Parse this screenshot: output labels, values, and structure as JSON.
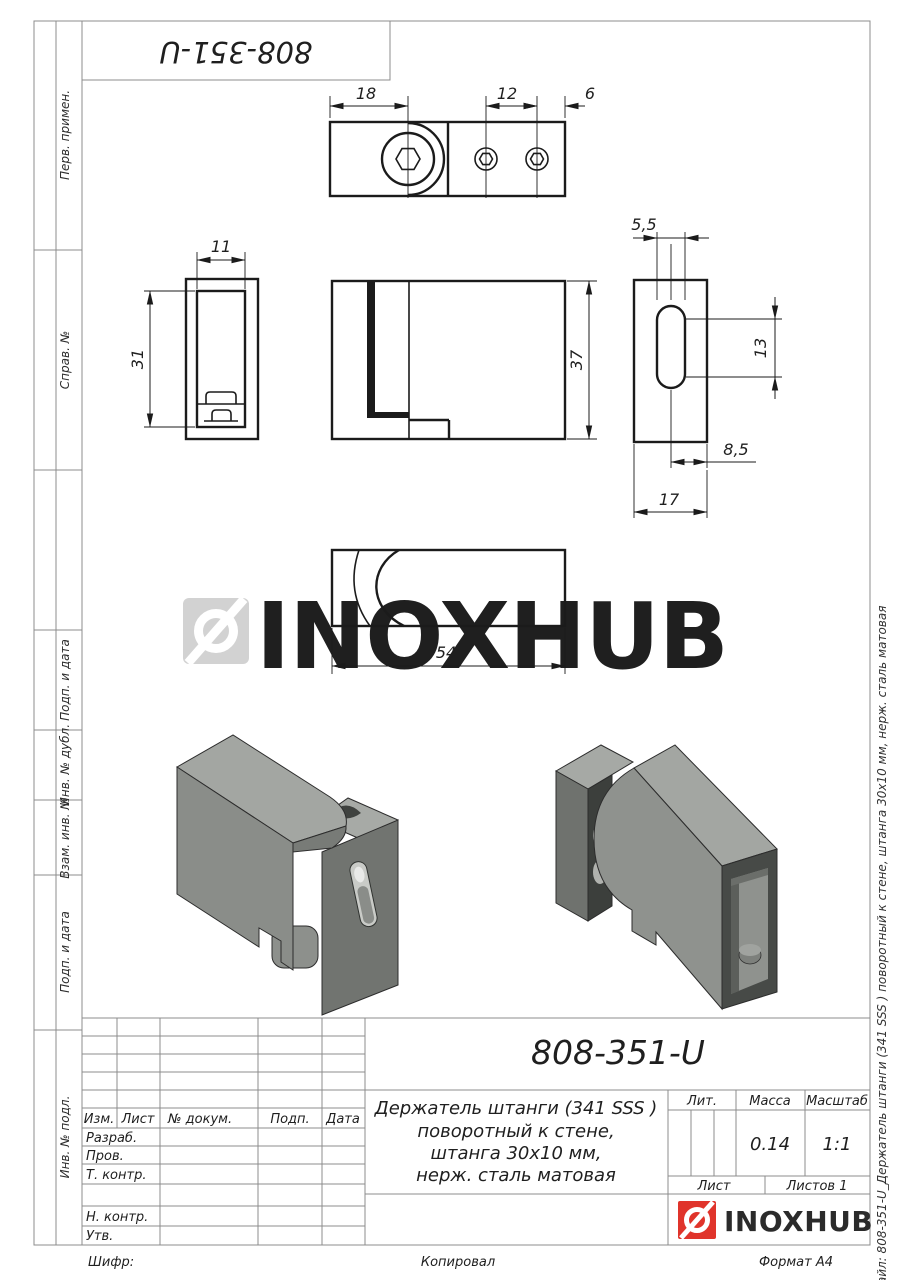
{
  "stamp": {
    "code": "808-351-U"
  },
  "sidebar_left": {
    "labels": [
      "Перв. примен.",
      "Справ. №",
      "Подп. и дата",
      "Инв. № дубл.",
      "Взам. инв. №",
      "Подп. и дата",
      "Инв. № подл."
    ]
  },
  "sidebar_right": {
    "file_note": "Файл: 808-351-U_Держатель штанги (341 SSS ) поворотный к стене, штанга 30х10 мм, нерж. сталь матовая"
  },
  "watermark": {
    "text": "INOXHUB"
  },
  "dimensions": {
    "top_width": "18",
    "top_pitch": "12",
    "top_edge": "6",
    "left_width": "11",
    "left_height": "31",
    "front_height": "37",
    "side_slot_width": "5,5",
    "side_slot_height": "13",
    "side_offset": "8,5",
    "side_width": "17",
    "bottom_length": "54"
  },
  "title_block": {
    "doc_number": "808-351-U",
    "description": [
      "Держатель штанги (341 SSS )",
      "поворотный к стене,",
      "штанга 30х10 мм,",
      "нерж. сталь матовая"
    ],
    "header_cols": {
      "izm": "Изм.",
      "list": "Лист",
      "doc": "№ докум.",
      "podp": "Подп.",
      "data": "Дата"
    },
    "rows": {
      "razrab": "Разраб.",
      "prov": "Пров.",
      "tkontr": "Т. контр.",
      "nkontr": "Н. контр.",
      "utv": "Утв."
    },
    "lit": "Лит.",
    "massa": "Масса",
    "masshtab": "Масштаб",
    "massa_value": "0.14",
    "masshtab_value": "1:1",
    "list": "Лист",
    "listov": "Листов 1",
    "brand": "INOXHUB"
  },
  "footer": {
    "shifr": "Шифр:",
    "kopiroval": "Копировал",
    "format": "Формат А4"
  },
  "colors": {
    "brand_red": "#e0342b",
    "watermark_gray": "#d2d2d2",
    "line": "#1b1b1b",
    "grid": "#8c8c8c"
  }
}
